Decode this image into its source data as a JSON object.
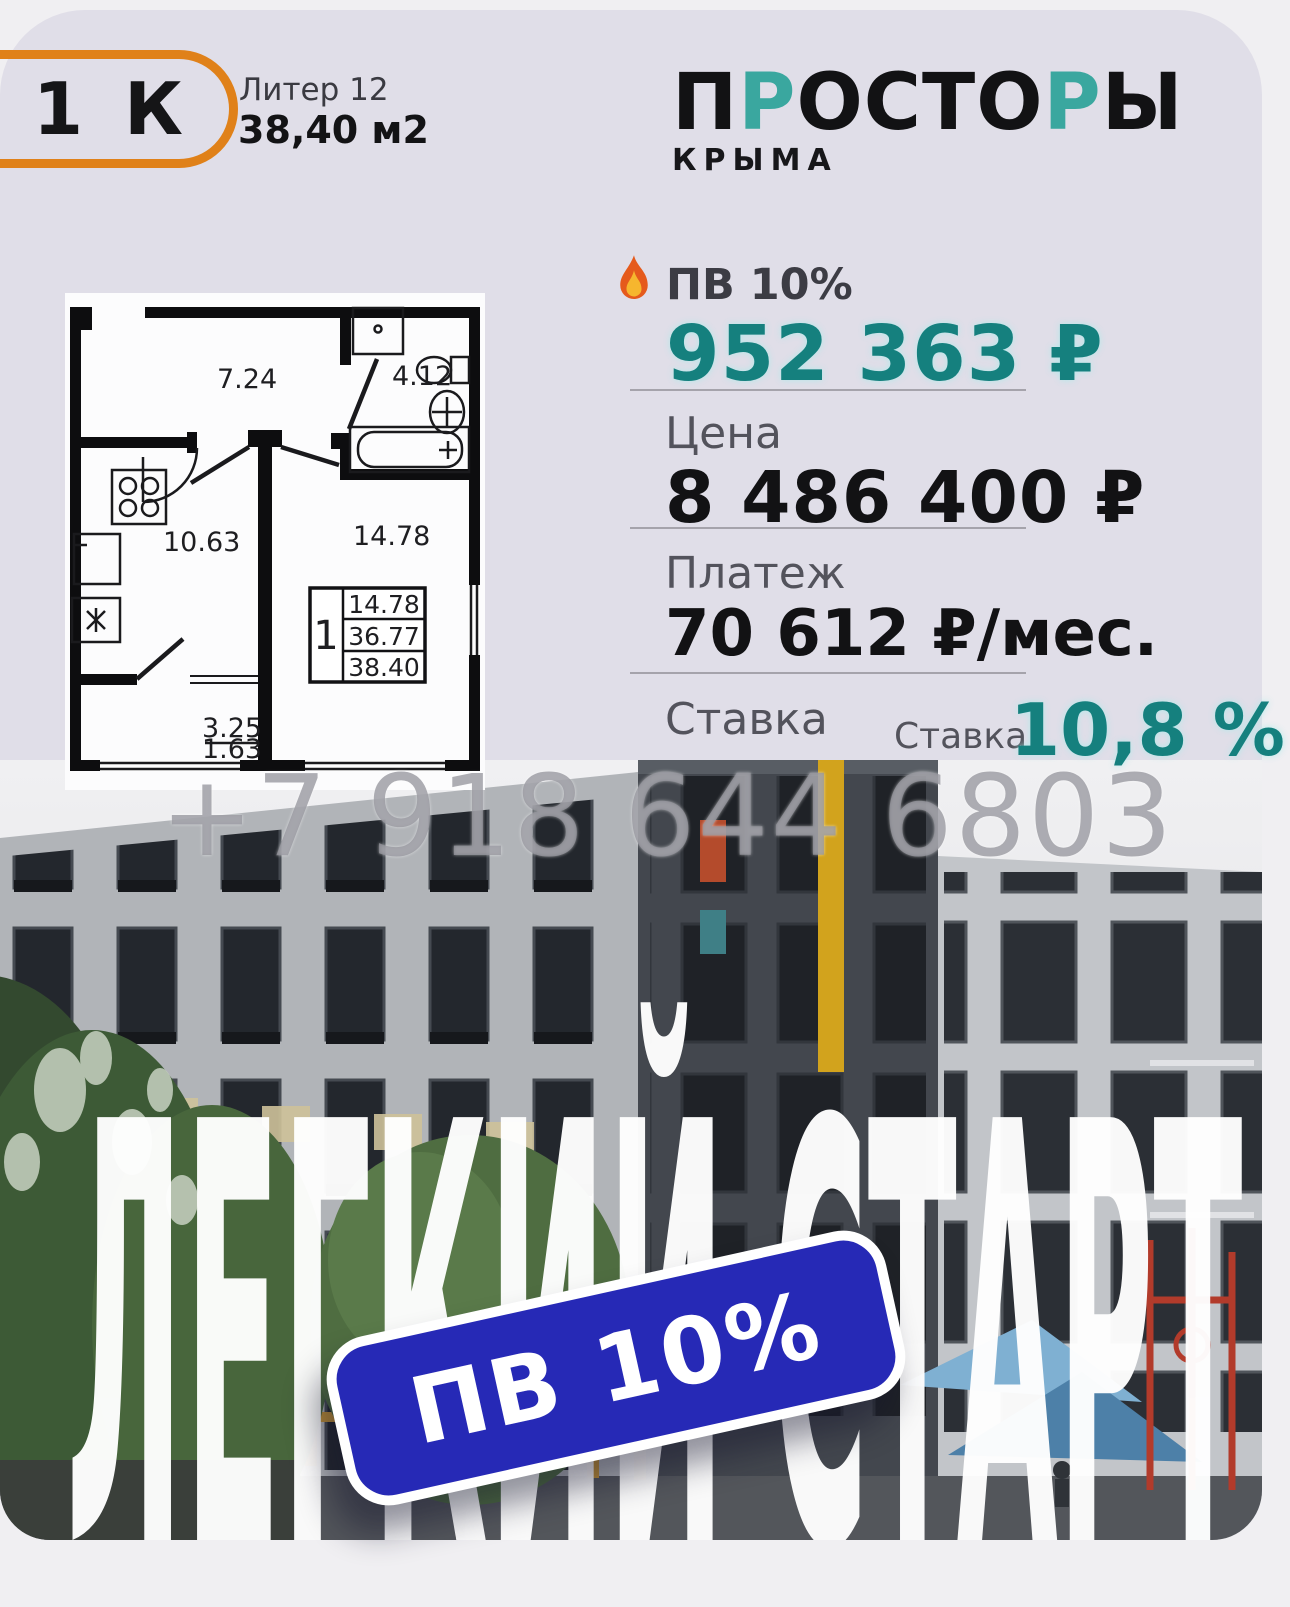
{
  "colors": {
    "card_bg": "#e0dee8",
    "outer_bg": "#f0eff2",
    "accent_teal": "#15807e",
    "logo_teal": "#3aa79f",
    "accent_orange": "#e08119",
    "badge_blue": "#2629b6",
    "text_dark": "#121214",
    "label_gray": "#53535c"
  },
  "header": {
    "rooms_badge": "1 К",
    "liter": "Литер 12",
    "area": "38,40 м2"
  },
  "logo": {
    "parts": [
      {
        "t": "П"
      },
      {
        "t": "Р"
      },
      {
        "t": "ОСТО"
      },
      {
        "t": "Р"
      },
      {
        "t": "Ы"
      }
    ],
    "sub": "КРЫМА"
  },
  "pricing": {
    "pv_label": "ПВ 10%",
    "pv_value": "952 363 ₽",
    "price_label": "Цена",
    "price_value": "8 486 400 ₽",
    "payment_label": "Платеж",
    "payment_value": "70 612 ₽/мес.",
    "rate_label": "Ставка",
    "rate_label_2": "Ставка",
    "rate_value": "10,8 %"
  },
  "floorplan": {
    "hall_area": "7.24",
    "bath_area": "4.12",
    "kitchen_area": "10.63",
    "living_area_label": "14.78",
    "balcony_upper": "3.25",
    "balcony_lower": "1.63",
    "table": {
      "rooms": "1",
      "living": "14.78",
      "without_balcony": "36.77",
      "total": "38.40"
    }
  },
  "watermark": "+7 918 644 6803",
  "hero": {
    "word1": "ЛЕГКИЙ",
    "word2": "СТАРТ",
    "badge": "ПВ 10%"
  }
}
